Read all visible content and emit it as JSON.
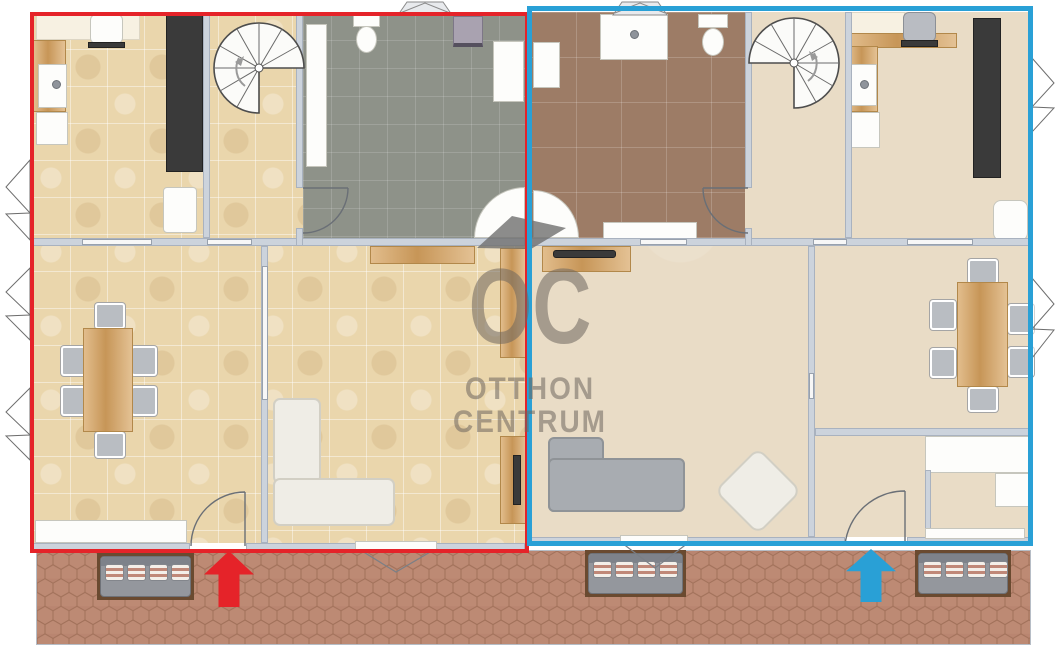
{
  "watermark": {
    "logo": "OC",
    "line1": "OTTHON",
    "line2": "CENTRUM"
  },
  "colors": {
    "left_outline": "#e52329",
    "right_outline": "#29a0d6",
    "tile_floor": "#ead6ac",
    "smooth_floor": "#e9dcc6",
    "gray_bath_floor": "#8e9289",
    "brown_bath_floor": "#9d7c66",
    "terrace_tile": "#bd8a73",
    "wall": "#ccd3dc",
    "wood": "#d8a766",
    "dark_cabinet": "#3a3a3a",
    "watermark_gray": "rgba(110,102,94,0.55)"
  },
  "units": {
    "left": {
      "outline": "#e52329",
      "entrance_arrow": "#e52329"
    },
    "right": {
      "outline": "#29a0d6",
      "entrance_arrow": "#29a0d6"
    }
  }
}
